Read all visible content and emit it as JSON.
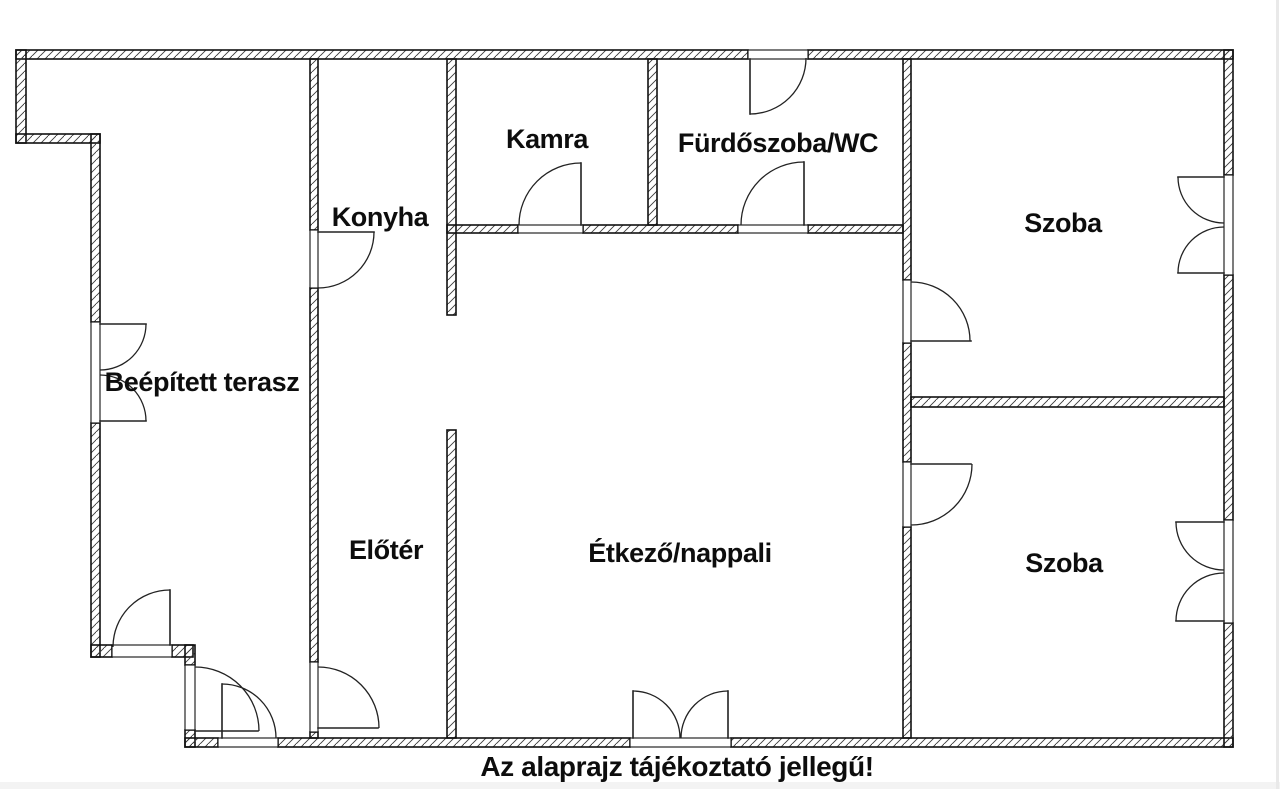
{
  "page": {
    "background": "#ffffff",
    "bottom_strip_color": "#f3f3f3",
    "right_edge_color": "#e9e9e9"
  },
  "floorplan": {
    "caption": "Az alaprajz tájékoztató jellegű!",
    "ink_color": "#111111",
    "canvas": {
      "width": 1280,
      "height": 789
    },
    "rooms": [
      {
        "id": "terasz",
        "label": "Beépített terasz",
        "x": 202,
        "y": 391
      },
      {
        "id": "konyha",
        "label": "Konyha",
        "x": 380,
        "y": 226
      },
      {
        "id": "kamra",
        "label": "Kamra",
        "x": 547,
        "y": 148
      },
      {
        "id": "furdoszoba",
        "label": "Fürdőszoba/WC",
        "x": 778,
        "y": 152
      },
      {
        "id": "szoba-1",
        "label": "Szoba",
        "x": 1063,
        "y": 232
      },
      {
        "id": "eloter",
        "label": "Előtér",
        "x": 386,
        "y": 559
      },
      {
        "id": "etkezo",
        "label": "Étkező/nappali",
        "x": 680,
        "y": 562
      },
      {
        "id": "szoba-2",
        "label": "Szoba",
        "x": 1064,
        "y": 572
      }
    ],
    "walls": [
      [
        16,
        50,
        732,
        9
      ],
      [
        808,
        50,
        425,
        9
      ],
      [
        16,
        50,
        10,
        93
      ],
      [
        16,
        134,
        84,
        9
      ],
      [
        91,
        134,
        9,
        188
      ],
      [
        91,
        423,
        9,
        234
      ],
      [
        91,
        645,
        21,
        12
      ],
      [
        172,
        645,
        21,
        12
      ],
      [
        185,
        645,
        10,
        20
      ],
      [
        185,
        730,
        10,
        17
      ],
      [
        185,
        738,
        33,
        9
      ],
      [
        278,
        738,
        352,
        9
      ],
      [
        731,
        738,
        502,
        9
      ],
      [
        1224,
        50,
        9,
        125
      ],
      [
        1224,
        275,
        9,
        245
      ],
      [
        1224,
        623,
        9,
        124
      ],
      [
        310,
        59,
        8,
        171
      ],
      [
        310,
        288,
        8,
        374
      ],
      [
        310,
        732,
        8,
        6
      ],
      [
        447,
        59,
        9,
        256
      ],
      [
        447,
        430,
        9,
        308
      ],
      [
        447,
        225,
        71,
        8
      ],
      [
        583,
        225,
        155,
        8
      ],
      [
        808,
        225,
        95,
        8
      ],
      [
        648,
        59,
        9,
        166
      ],
      [
        903,
        59,
        8,
        221
      ],
      [
        903,
        343,
        8,
        119
      ],
      [
        903,
        527,
        8,
        211
      ],
      [
        911,
        397,
        313,
        10
      ]
    ],
    "openings": [
      [
        748,
        50,
        60,
        9
      ],
      [
        91,
        322,
        9,
        101
      ],
      [
        1224,
        175,
        9,
        100
      ],
      [
        1224,
        520,
        9,
        103
      ],
      [
        310,
        230,
        8,
        58
      ],
      [
        310,
        662,
        8,
        70
      ],
      [
        518,
        225,
        65,
        8
      ],
      [
        738,
        225,
        70,
        8
      ],
      [
        903,
        280,
        8,
        63
      ],
      [
        903,
        462,
        8,
        65
      ],
      [
        218,
        738,
        60,
        9
      ],
      [
        630,
        738,
        101,
        9
      ],
      [
        185,
        665,
        10,
        65
      ],
      [
        112,
        645,
        60,
        12
      ]
    ],
    "doors": [
      {
        "name": "konyha-door",
        "leaves": [
          [
            318,
            232,
            374,
            232
          ]
        ],
        "arcs": [
          "M374,232 A56,56 0 0 1 318,288"
        ]
      },
      {
        "name": "eloter-door",
        "leaves": [
          [
            318,
            728,
            378,
            728
          ]
        ],
        "arcs": [
          "M318,667 A61,61 0 0 1 379,728"
        ]
      },
      {
        "name": "kamra-door",
        "leaves": [
          [
            581,
            163,
            581,
            225
          ]
        ],
        "arcs": [
          "M519,225 A62,62 0 0 1 581,163"
        ]
      },
      {
        "name": "furdoszoba-door",
        "leaves": [
          [
            804,
            162,
            804,
            225
          ]
        ],
        "arcs": [
          "M741,225 A63,63 0 0 1 804,162"
        ]
      },
      {
        "name": "szoba-1-door",
        "leaves": [
          [
            911,
            341,
            971,
            341
          ]
        ],
        "arcs": [
          "M911,282 A59,59 0 0 1 970,341"
        ]
      },
      {
        "name": "szoba-2-door",
        "leaves": [
          [
            911,
            464,
            971,
            464
          ]
        ],
        "arcs": [
          "M911,525 A61,61 0 0 0 972,464"
        ]
      },
      {
        "name": "terrace-french-door",
        "leaves": [
          [
            633,
            691,
            633,
            738
          ],
          [
            728,
            691,
            728,
            738
          ]
        ],
        "arcs": [
          "M633,691 A47,47 0 0 1 680,738",
          "M728,691 A47,47 0 0 0 681,738"
        ]
      },
      {
        "name": "entrance-door",
        "leaves": [
          [
            222,
            684,
            222,
            738
          ]
        ],
        "arcs": [
          "M222,684 A54,54 0 0 1 276,738"
        ]
      },
      {
        "name": "vestibule-door",
        "leaves": [
          [
            195,
            731,
            258,
            731
          ]
        ],
        "arcs": [
          "M195,667 A64,64 0 0 1 259,731"
        ]
      },
      {
        "name": "terrace-step-door",
        "leaves": [
          [
            170,
            590,
            170,
            645
          ]
        ],
        "arcs": [
          "M113,647 A57,57 0 0 1 170,590"
        ]
      }
    ],
    "windows": [
      {
        "name": "terrace-window",
        "leaves": [
          [
            100,
            324,
            146,
            324
          ],
          [
            100,
            421,
            146,
            421
          ]
        ],
        "arcs": [
          "M146,324 A46,46 0 0 1 100,370",
          "M146,421 A46,46 0 0 0 100,375"
        ]
      },
      {
        "name": "szoba-1-window",
        "leaves": [
          [
            1178,
            177,
            1224,
            177
          ],
          [
            1178,
            273,
            1224,
            273
          ]
        ],
        "arcs": [
          "M1178,177 A46,46 0 0 0 1224,223",
          "M1178,273 A46,46 0 0 1 1224,227"
        ]
      },
      {
        "name": "szoba-2-window",
        "leaves": [
          [
            1176,
            522,
            1224,
            522
          ],
          [
            1176,
            621,
            1224,
            621
          ]
        ],
        "arcs": [
          "M1176,522 A48,48 0 0 0 1224,570",
          "M1176,621 A48,48 0 0 1 1224,573"
        ]
      },
      {
        "name": "furdoszoba-window",
        "leaves": [
          [
            750,
            59,
            750,
            114
          ]
        ],
        "arcs": [
          "M750,114 A56,56 0 0 0 806,58"
        ]
      }
    ]
  }
}
